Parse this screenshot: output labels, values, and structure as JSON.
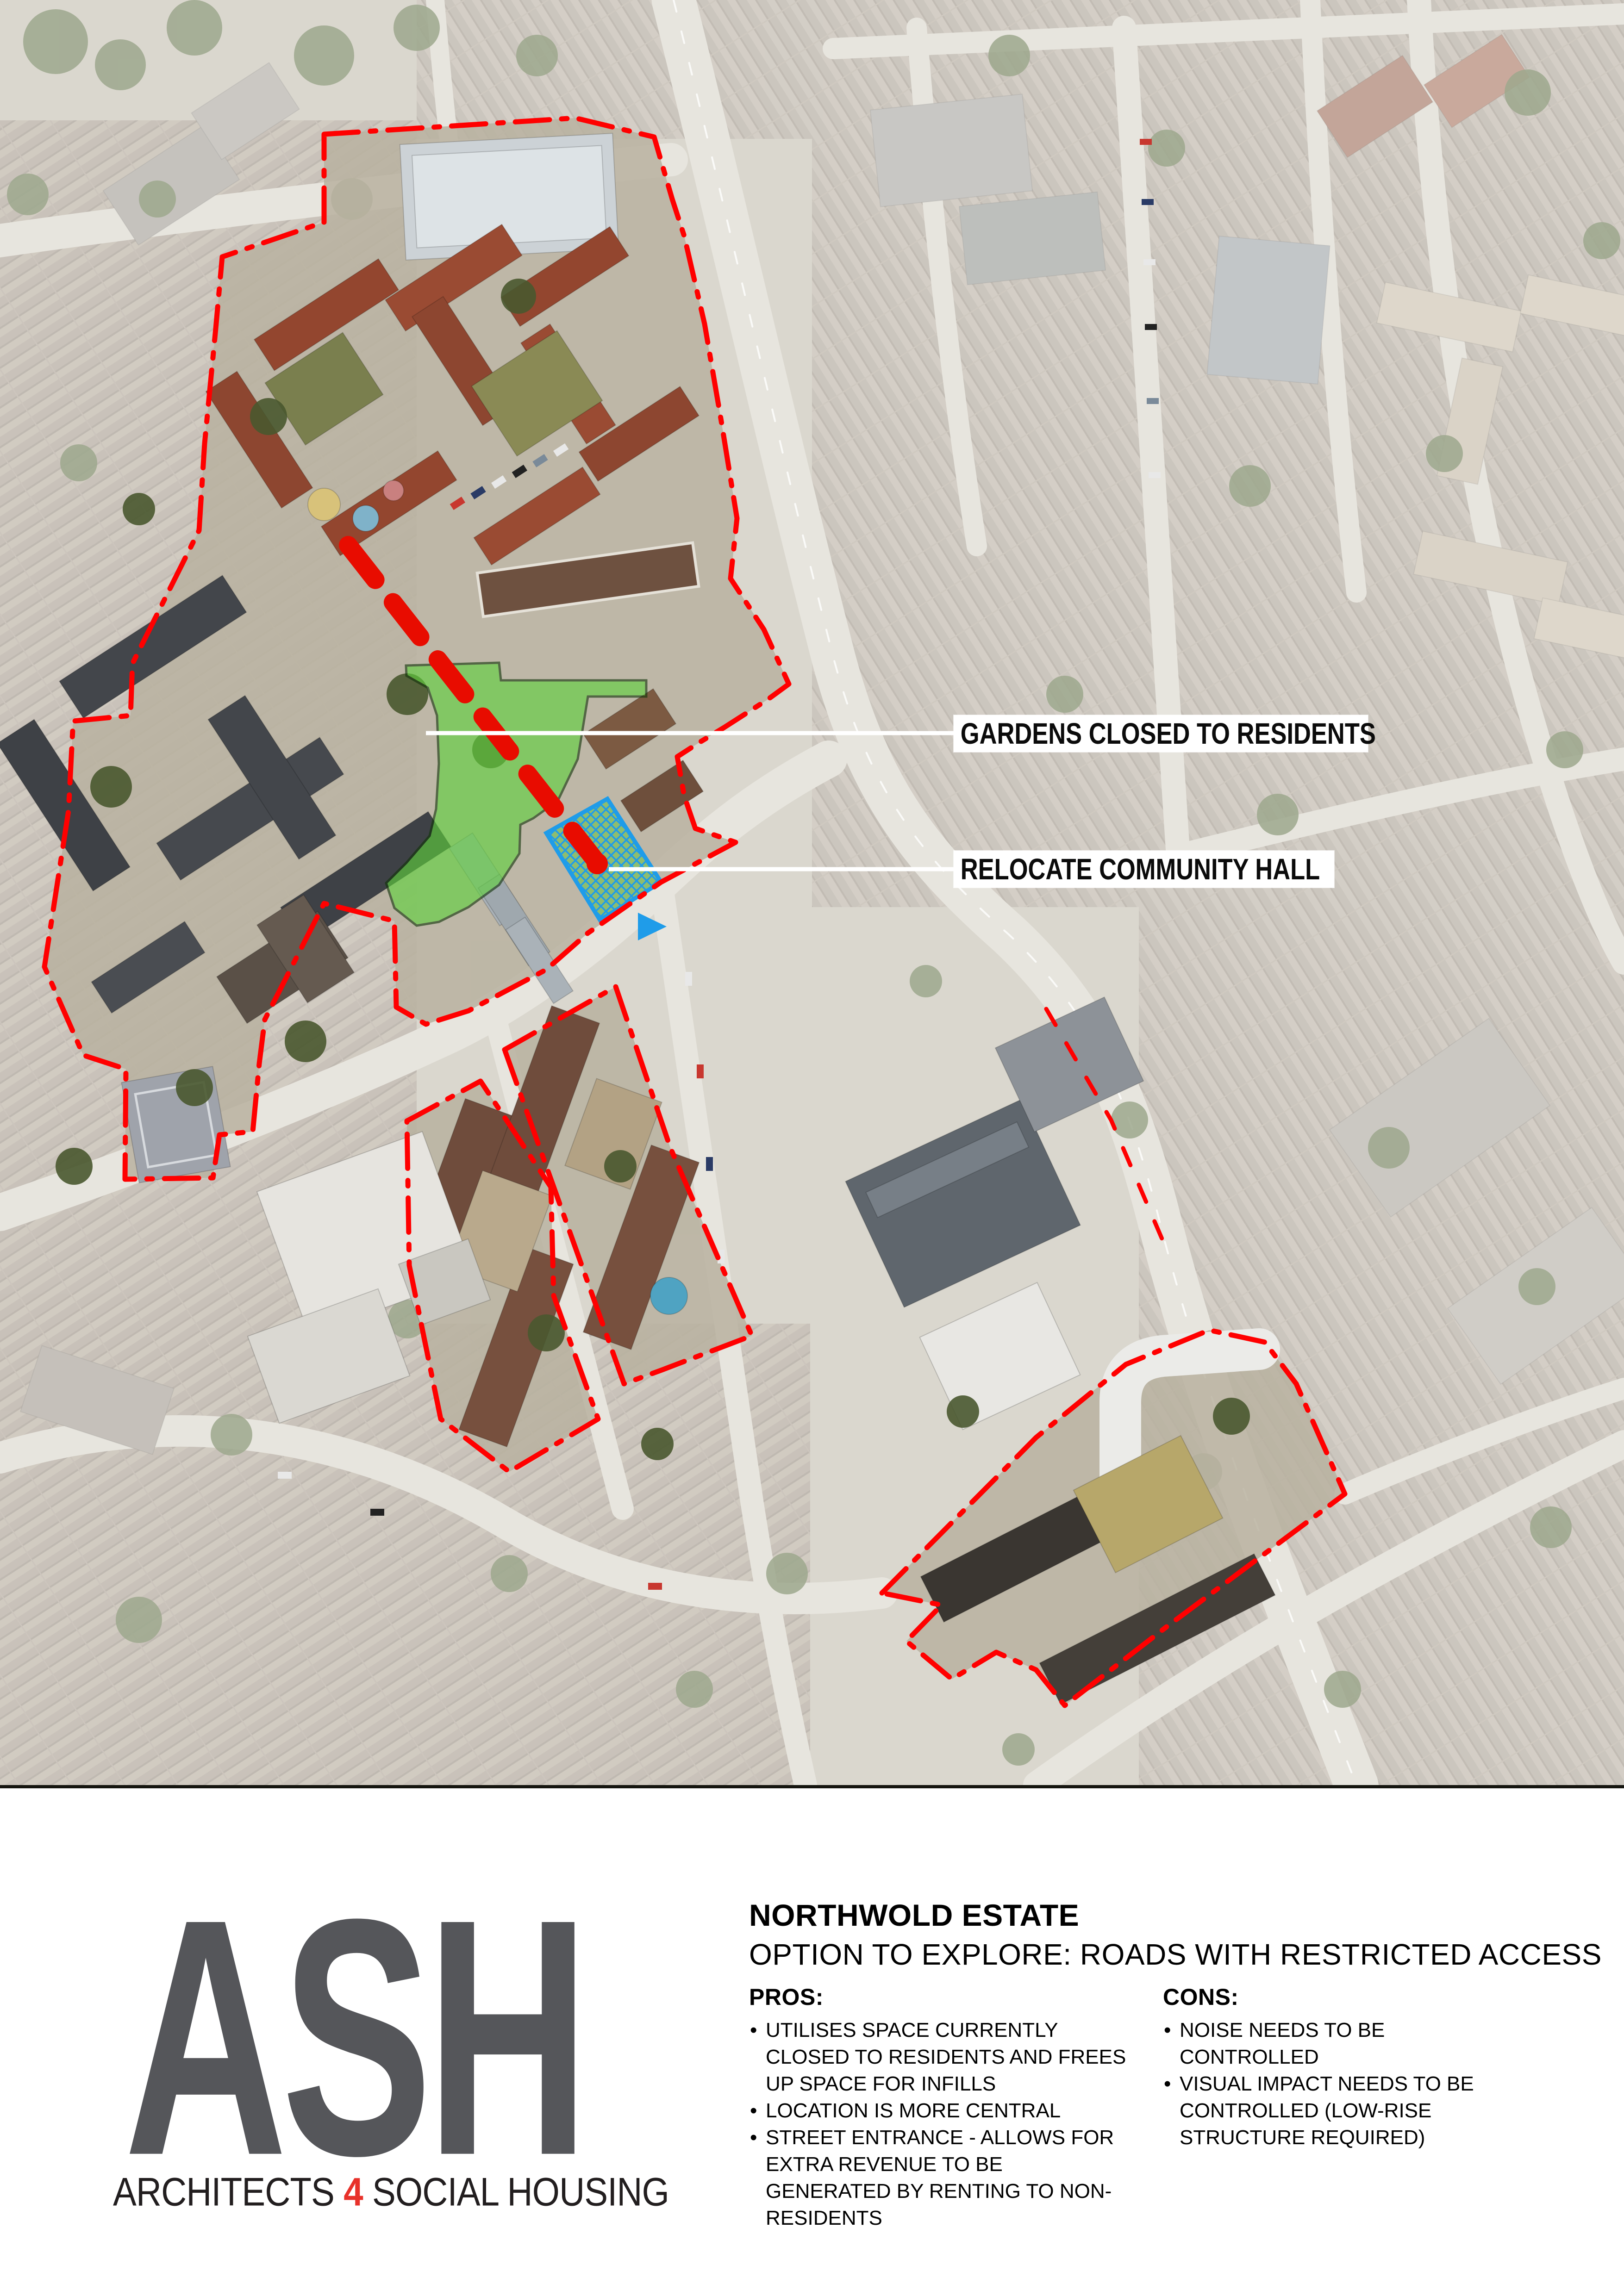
{
  "map": {
    "annotations": {
      "gardens_label": "GARDENS CLOSED TO RESIDENTS",
      "relocate_label": "RELOCATE COMMUNITY HALL"
    },
    "colors": {
      "estate_boundary_red": "#ff0000",
      "route_arrow_red": "#e80c00",
      "garden_zone_green": "#5fd23c",
      "hall_zone_blue": "#1f9ce9"
    }
  },
  "footer": {
    "logo": {
      "text": "ASH",
      "tagline_1": "ARCHITECTS",
      "tagline_num": "4",
      "tagline_2": "SOCIAL HOUSING",
      "logo_color": "#55565a",
      "accent_color": "#e8312a"
    },
    "title": "NORTHWOLD ESTATE",
    "subtitle": "OPTION TO EXPLORE: ROADS WITH RESTRICTED ACCESS",
    "pros": {
      "heading": "PROS:",
      "items": [
        "UTILISES SPACE CURRENTLY CLOSED TO RESIDENTS AND FREES UP SPACE FOR INFILLS",
        "LOCATION IS MORE CENTRAL",
        "STREET ENTRANCE - ALLOWS FOR EXTRA REVENUE TO BE GENERATED BY RENTING TO NON-RESIDENTS"
      ]
    },
    "cons": {
      "heading": "CONS:",
      "items": [
        "NOISE NEEDS TO BE CONTROLLED",
        "VISUAL IMPACT NEEDS TO BE CONTROLLED (LOW-RISE STRUCTURE REQUIRED)"
      ]
    }
  }
}
